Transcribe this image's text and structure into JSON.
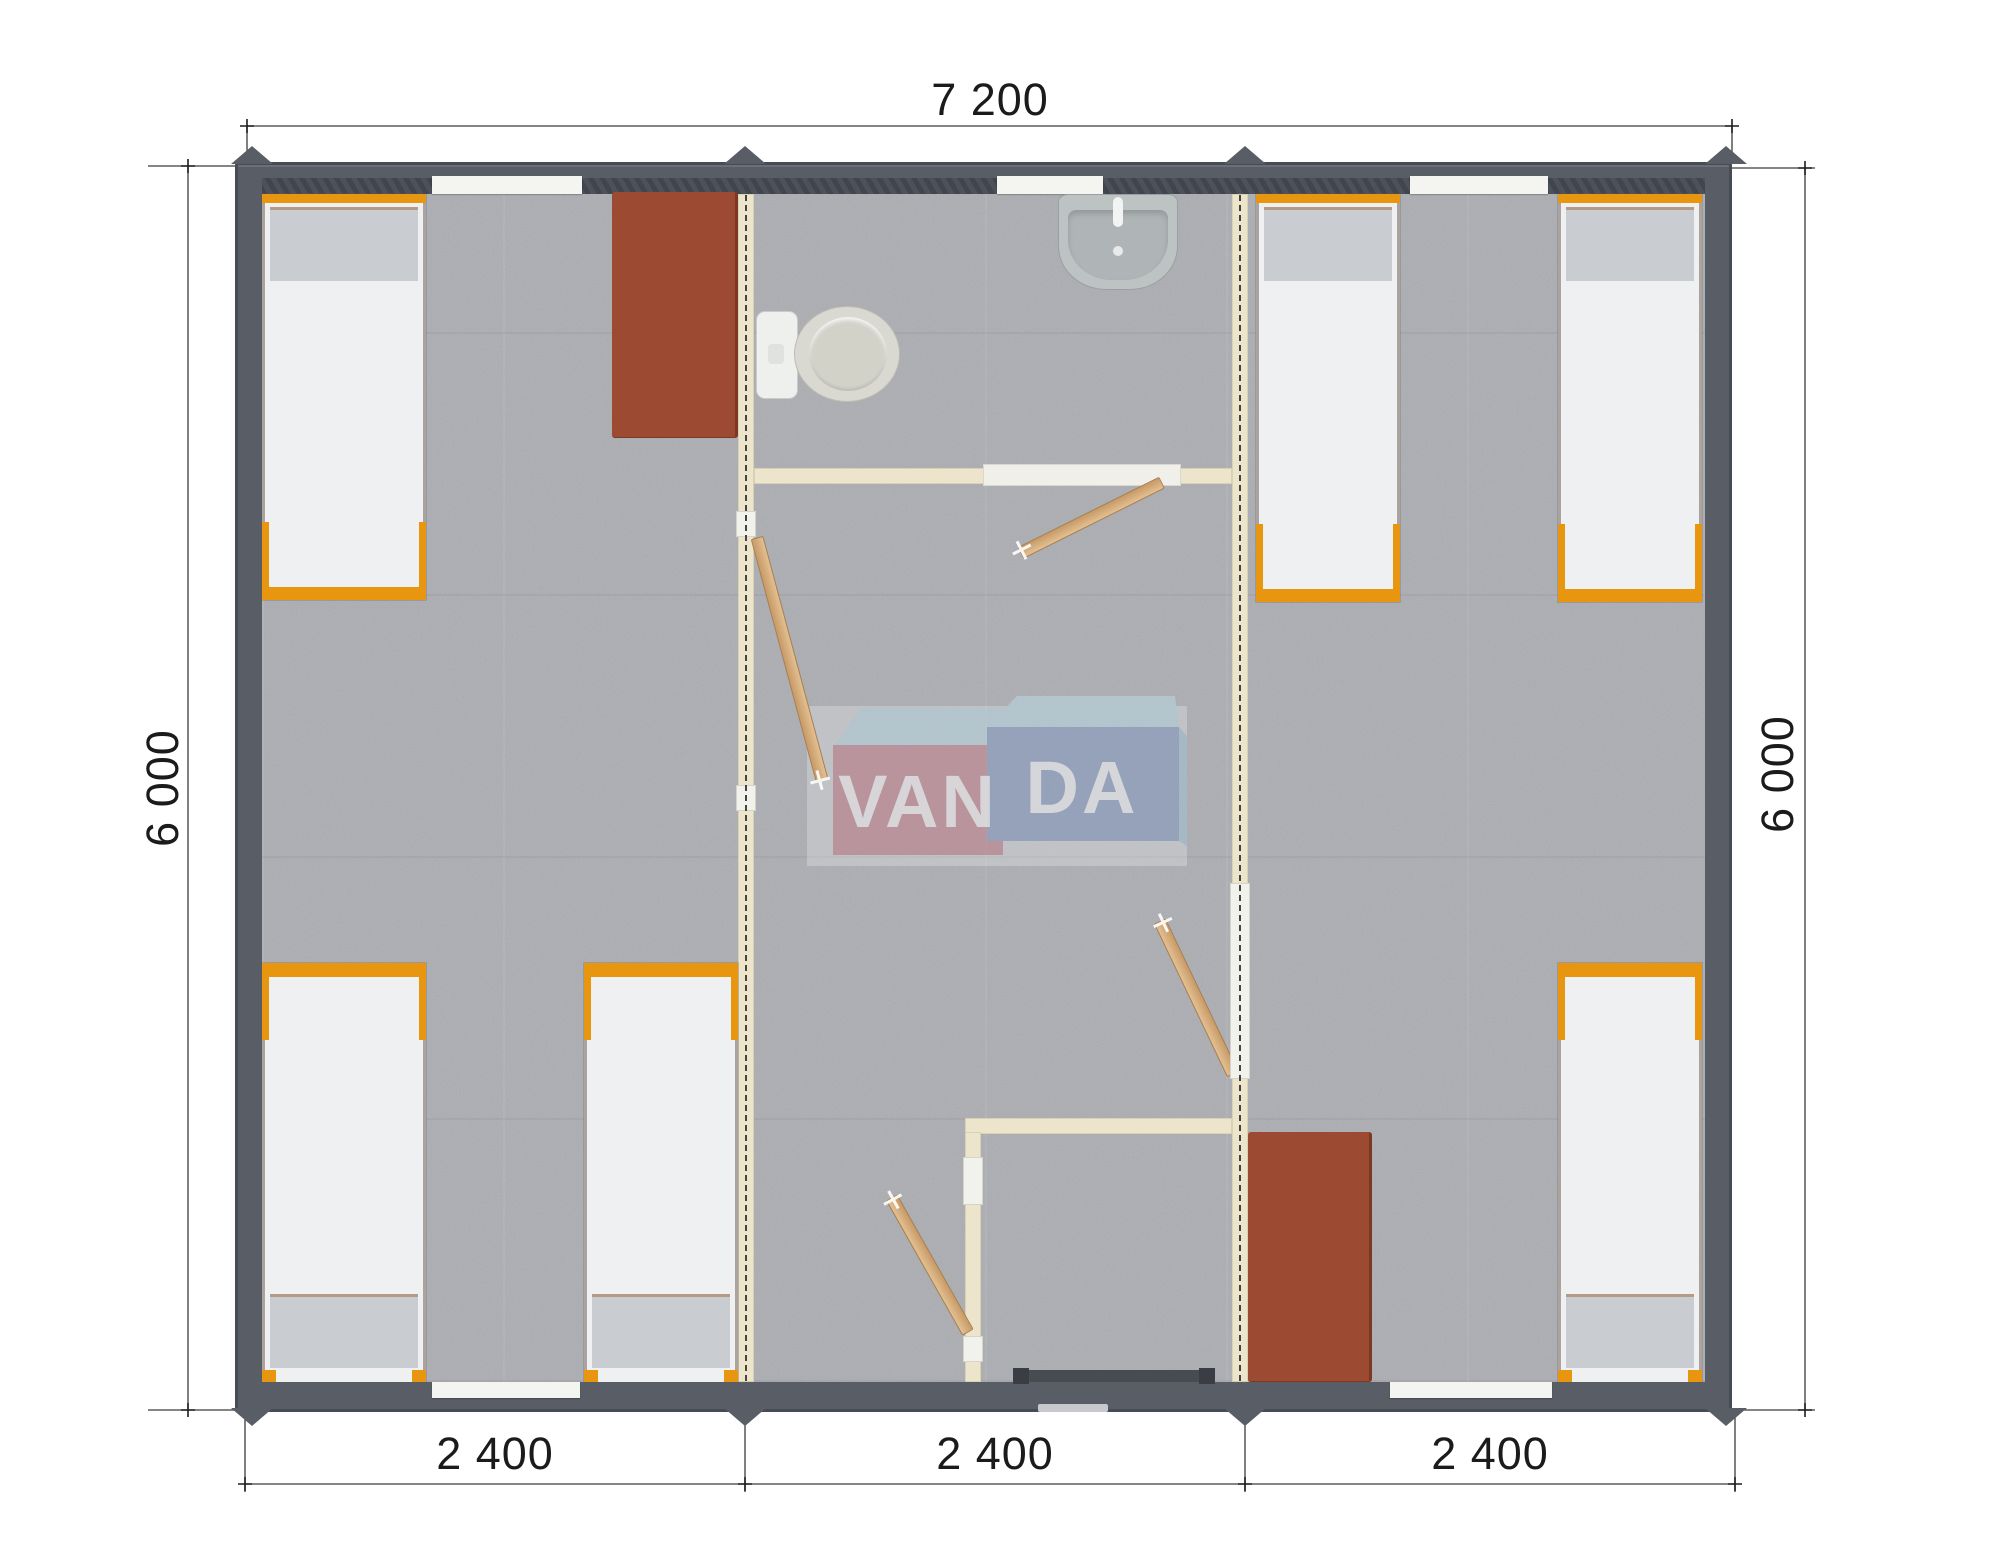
{
  "dimensions": {
    "top_width": "7 200",
    "left_height": "6 000",
    "right_height": "6 000",
    "bottom_segments": [
      "2 400",
      "2 400",
      "2 400"
    ]
  },
  "logo": {
    "full": "VANDA",
    "part1": "VAN",
    "part2": "DA"
  },
  "colors": {
    "wall": "#585d66",
    "floor": "#abadb2",
    "partition": "#ece5cb",
    "bed_frame_orange": "#e8960f",
    "mattress": "#eef0f2",
    "pillow": "#c9cdd2",
    "desk_rust": "#9c4a31",
    "door_wood": "#d4ab79",
    "logo_pink": "#c47f8a",
    "logo_blue": "#8399c1",
    "logo_cyan": "#b9d7e3",
    "dimension_text": "#1b1b1b"
  }
}
